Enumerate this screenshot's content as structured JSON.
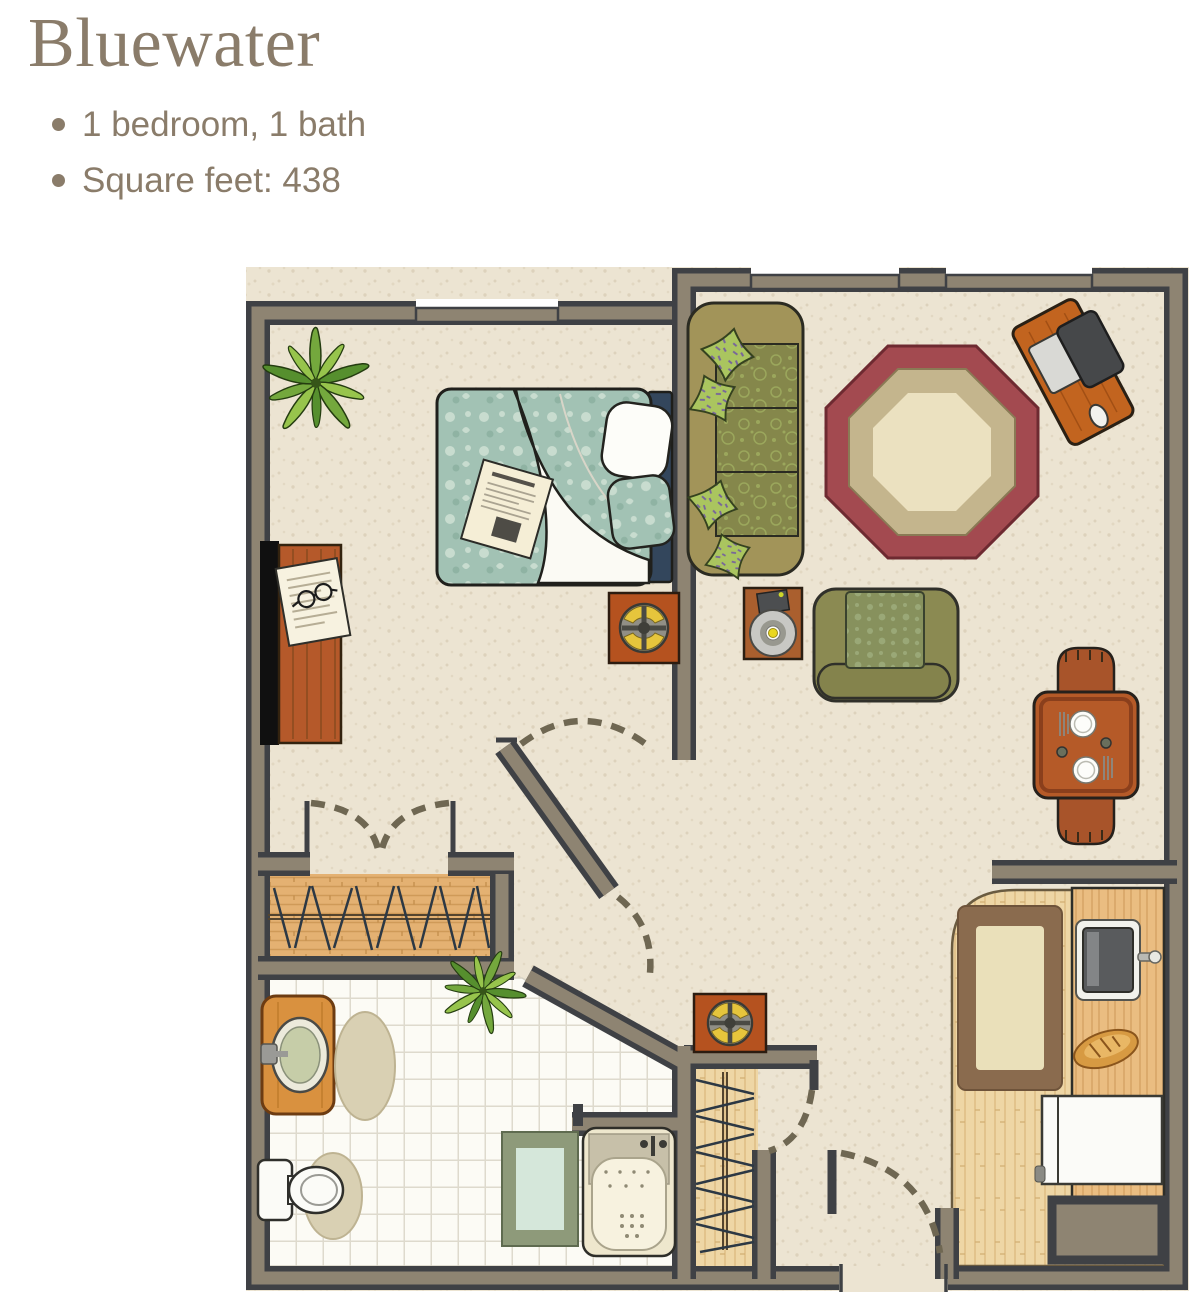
{
  "header": {
    "title": "Bluewater",
    "bullets": [
      "1 bedroom, 1 bath",
      "Square feet: 438"
    ]
  },
  "floorplan": {
    "rooms": [
      "bedroom",
      "living room",
      "bathroom",
      "kitchenette",
      "entry hall",
      "bedroom closet",
      "entry closet"
    ],
    "furniture": [
      "bed with teal duvet and pillows",
      "dresser with tv",
      "nightstand table with compass motif",
      "potted plants",
      "sofa with green pillows",
      "octagonal area rug",
      "computer desk with monitor and mouse",
      "lamp side table",
      "armchair",
      "dining table with two chairs and place settings",
      "hall side table",
      "clothes hangers on rods",
      "vanity sink",
      "toilet",
      "bathtub",
      "bath mat",
      "oval bath rugs",
      "kitchen rug",
      "kitchen counter with sink",
      "bread loaf",
      "refrigerator",
      "utility unit"
    ]
  },
  "colors": {
    "inkText": "#8a7c6a",
    "wallFill": "#8e8472",
    "wallEdge": "#3f4145",
    "carpet": "#ece4d2",
    "tile": "#fcfbf5",
    "woodCloset": "#e4b172",
    "kitchenFloor": "#eed6a5",
    "furnWood": "#b5592a",
    "oliveSofa": "#a29459",
    "oliveCushion": "#85874b",
    "pillowGreen": "#aac55f",
    "rugMaroon": "#a34a50",
    "rugTan": "#c4b58d",
    "rugCream": "#ebe1c0",
    "bedTeal": "#a2c2b4",
    "headboardNavy": "#33465c",
    "matGreen": "#8e9a7a",
    "matInner": "#d5e7da",
    "beigeRug": "#d9d0b3",
    "doorDash": "#6f6752"
  }
}
